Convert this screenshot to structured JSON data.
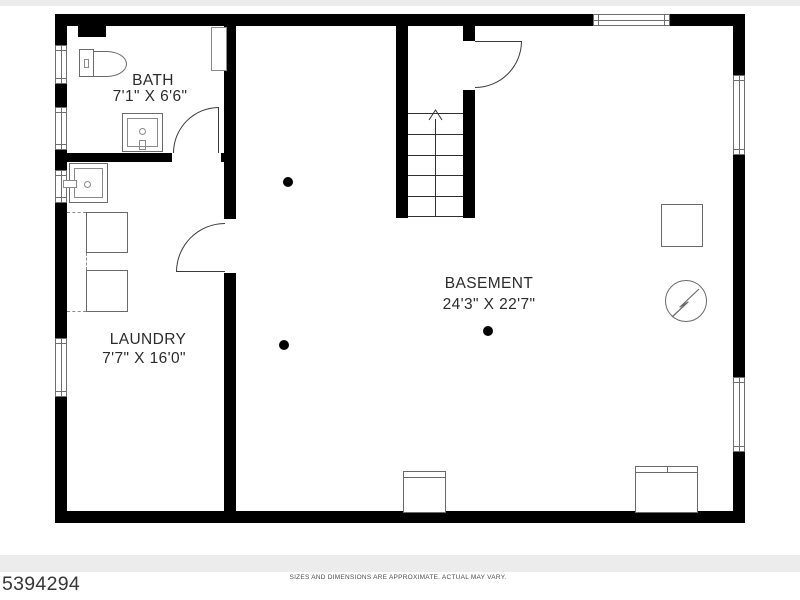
{
  "colors": {
    "wall": "#000000",
    "fixture_outline": "#6a6a6a",
    "label_text": "#2b2b2b",
    "edge_band": "#ececec"
  },
  "rooms": [
    {
      "id": "bath",
      "name": "BATH",
      "dimensions": "7'1\" X 6'6\""
    },
    {
      "id": "laundry",
      "name": "LAUNDRY",
      "dimensions": "7'7\" X 16'0\""
    },
    {
      "id": "basement",
      "name": "BASEMENT",
      "dimensions": "24'3\" X 22'7\""
    }
  ],
  "footer": {
    "mls_number": "5394294",
    "disclaimer": "SIZES AND DIMENSIONS ARE APPROXIMATE. ACTUAL MAY VARY."
  },
  "symbols": [
    "toilet-icon",
    "bathroom-sink-icon",
    "wall-cabinet-icon",
    "laundry-sink-icon",
    "washer-icon",
    "dryer-icon",
    "stairs-up-icon",
    "door-swing-icon",
    "window-icon",
    "support-column-icon",
    "equipment-box-icon",
    "electrical-meter-icon",
    "appliance-icon"
  ]
}
